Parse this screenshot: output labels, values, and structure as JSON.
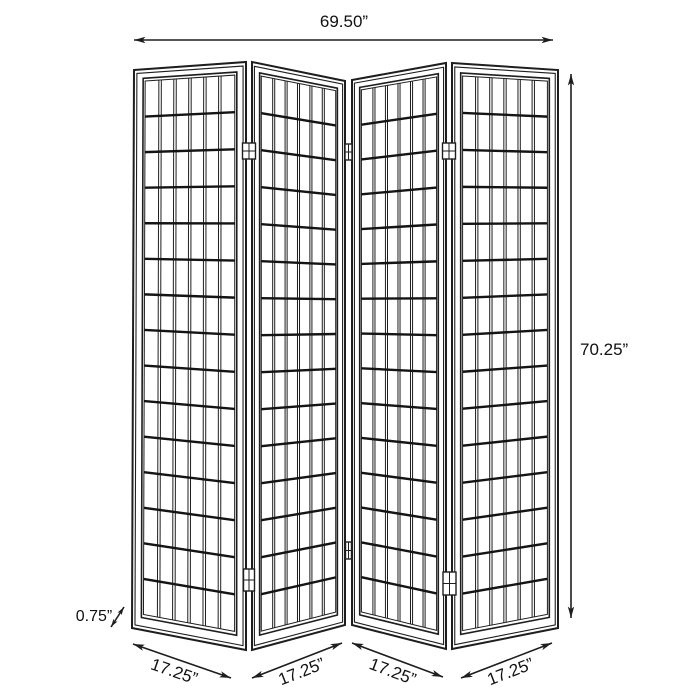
{
  "diagram": {
    "panel_count": 4,
    "dimensions": {
      "overall_width": "69.50”",
      "overall_height": "70.25”",
      "panel_thickness": "0.75”",
      "panel_widths": [
        "17.25”",
        "17.25”",
        "17.25”",
        "17.25”"
      ]
    },
    "colors": {
      "line": "#1e1e1e",
      "rail": "#141414",
      "text": "#111111",
      "background": "#ffffff"
    }
  }
}
